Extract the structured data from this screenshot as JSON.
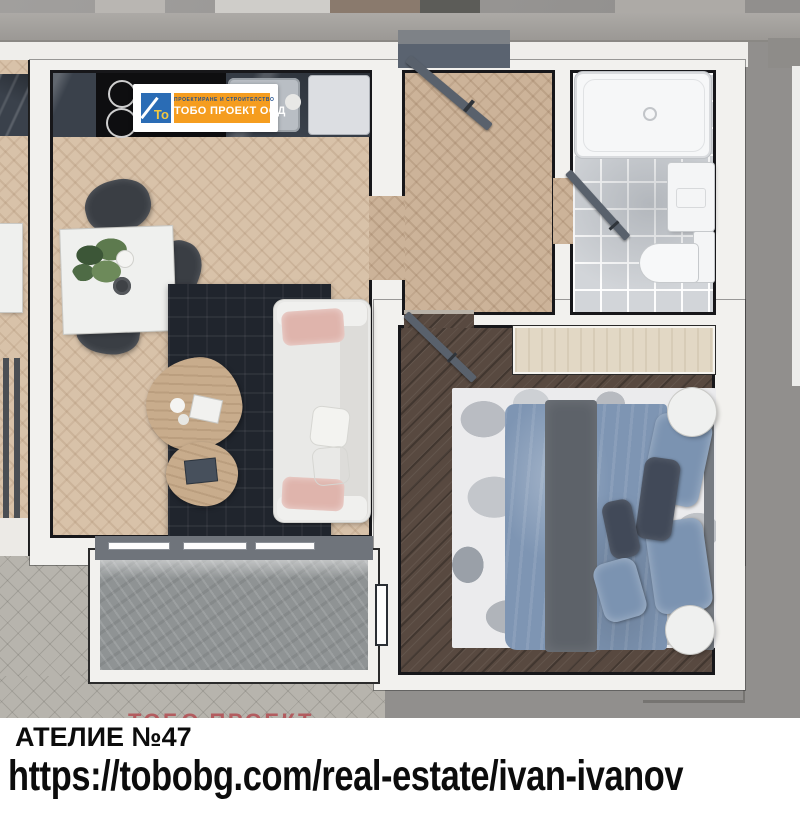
{
  "scene": {
    "kind": "apartment-floor-plan-render",
    "width_px": 800,
    "height_px": 820
  },
  "logo": {
    "monogram": "То",
    "tagline": "ПРОЕКТИРАНЕ  И  СТРОИТЕЛСТВО",
    "company": "ТОБО ПРОЕКТ ООД",
    "colors": {
      "badge_bg": "#ffffff",
      "monogram_bg": "#2a6cb5",
      "monogram_color": "#f3c83e",
      "band_bg": "#f59d1f",
      "tagline_color": "#1f4f8e",
      "company_color": "#ffffff"
    }
  },
  "watermark": {
    "text": "ТОБО ПРОЕКТ",
    "color": "#b94e54"
  },
  "footer": {
    "title": "АТЕЛИЕ №47",
    "url": "https://tobobg.com/real-estate/ivan-ivanov",
    "text_color": "#0c0c0c",
    "bg": "#ffffff"
  },
  "palette": {
    "exterior_concrete": "#9e9c98",
    "exterior_paving": "#b7b4ad",
    "wall_fill": "#f2f1ee",
    "wall_outline": "#17171a",
    "living_parquet": "#d8c2a9",
    "hall_parquet": "#ccb399",
    "bedroom_floor": "#584940",
    "bathroom_tiles": "#d2d5d9",
    "kitchen_counter": "#3a414b",
    "living_rug": "#20252d",
    "bedroom_rug": "#ebebed",
    "sofa": "#eff0ee",
    "sofa_pillow_pink": "#dfb4ac",
    "bed_duvet": "#7e95b3",
    "bed_runner": "#5d6269",
    "balcony_stone": "#8f9394",
    "door_leaf": "#59616c",
    "wardrobe": "#e2d8c5",
    "coffee_table": "#c8ac8c"
  }
}
